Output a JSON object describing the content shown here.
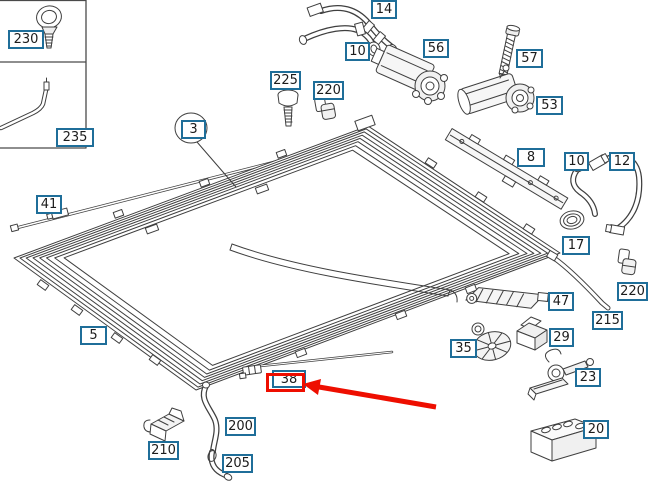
{
  "diagram": {
    "kind": "exploded-parts-diagram",
    "subject": "sunroof / sliding-roof frame assembly",
    "background": "#ffffff",
    "line_color": "#3f3f3f",
    "label_border_color": "#1f6e99"
  },
  "labels": {
    "p230": "230",
    "p235": "235",
    "p41": "41",
    "p3": "3",
    "p5": "5",
    "p14": "14",
    "p10a": "10",
    "p56": "56",
    "p225": "225",
    "p220a": "220",
    "p57": "57",
    "p53": "53",
    "p8": "8",
    "p10b": "10",
    "p12": "12",
    "p17": "17",
    "p220b": "220",
    "p215": "215",
    "p47": "47",
    "p35": "35",
    "p29": "29",
    "p23": "23",
    "p20": "20",
    "p210": "210",
    "p200": "200",
    "p205": "205",
    "p38": "38"
  },
  "highlight": {
    "highlighted_part": "38",
    "box_color": "#ee0e00",
    "arrow_color": "#ee0e00"
  }
}
